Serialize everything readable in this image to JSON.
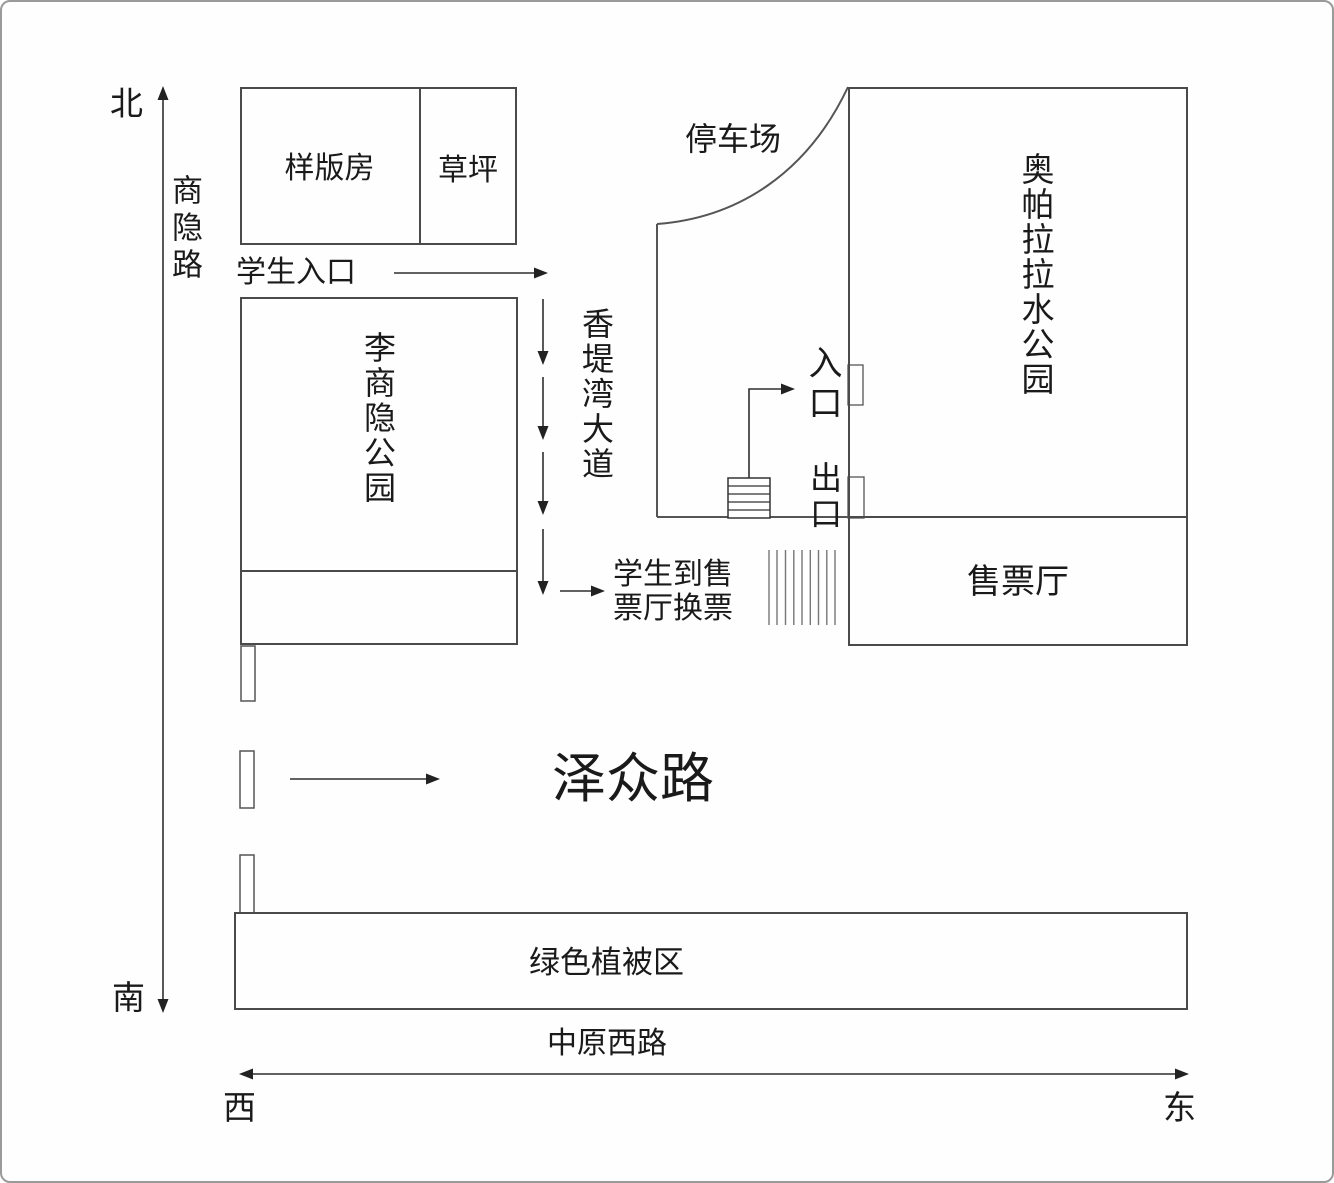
{
  "compass": {
    "north": "北",
    "south": "南",
    "west": "西",
    "east": "东"
  },
  "roads": {
    "shangyin_road": "商隐路",
    "xiangdiwan_avenue": "香堤湾大道",
    "zezhong_road": "泽众路",
    "zhongyuan_west_road": "中原西路"
  },
  "places": {
    "sample_room": "样版房",
    "lawn": "草坪",
    "li_shangyin_park": "李商隐公园",
    "parking_lot": "停车场",
    "water_park": "奥帕拉拉水公园",
    "entrance": "入口",
    "exit": "出口",
    "ticket_hall": "售票厅",
    "green_vegetation_area": "绿色植被区"
  },
  "notes": {
    "student_entrance": "学生入口",
    "exchange_tickets": "学生到售\n票厅换票"
  },
  "colors": {
    "line": "#2f2f2f",
    "box_border": "#4a4a4a",
    "canvas_border": "#9a9a9a",
    "text": "#1a1a1a",
    "crosswalk": "#777777"
  }
}
